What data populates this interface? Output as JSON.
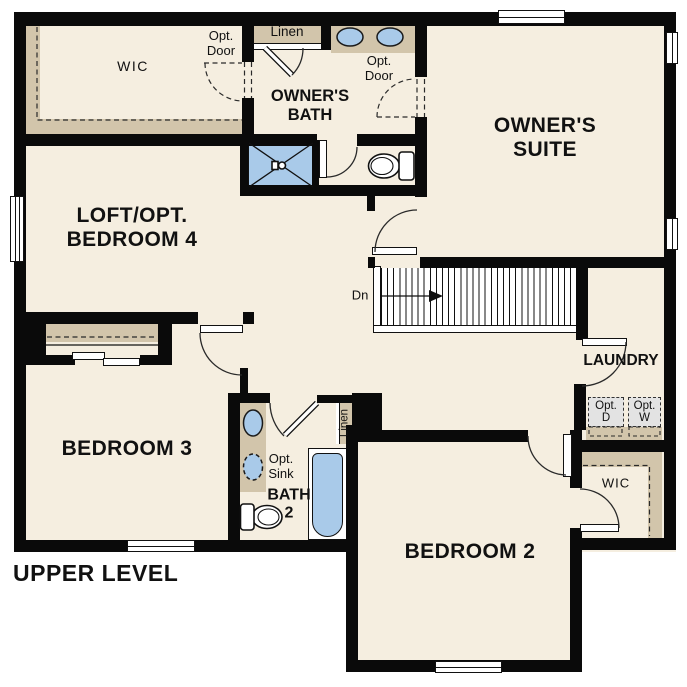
{
  "plan": {
    "level_label": "UPPER LEVEL",
    "rooms": {
      "wic_main": "WIC",
      "owners_bath": "OWNER'S\nBATH",
      "owners_suite": "OWNER'S\nSUITE",
      "loft": "LOFT/OPT.\nBEDROOM 4",
      "laundry": "LAUNDRY",
      "bedroom3": "BEDROOM 3",
      "bath2": "BATH\n2",
      "bedroom2": "BEDROOM 2",
      "wic_bedroom2": "WIC"
    },
    "labels": {
      "opt_door_wic": "Opt.\nDoor",
      "opt_door_suite": "Opt.\nDoor",
      "linen_top": "Linen",
      "linen_bath2": "Linen",
      "opt_sink": "Opt.\nSink",
      "opt_dryer": "Opt.\nD",
      "opt_washer": "Opt.\nW",
      "stairs_down": "Dn"
    },
    "colors": {
      "floor": "#f5eee0",
      "wall": "#0a0a0a",
      "casework_tan": "#d2c5ab",
      "fixture_blue": "#a9cae9",
      "appliance_gray": "#e3e3e3",
      "background": "#ffffff"
    }
  }
}
